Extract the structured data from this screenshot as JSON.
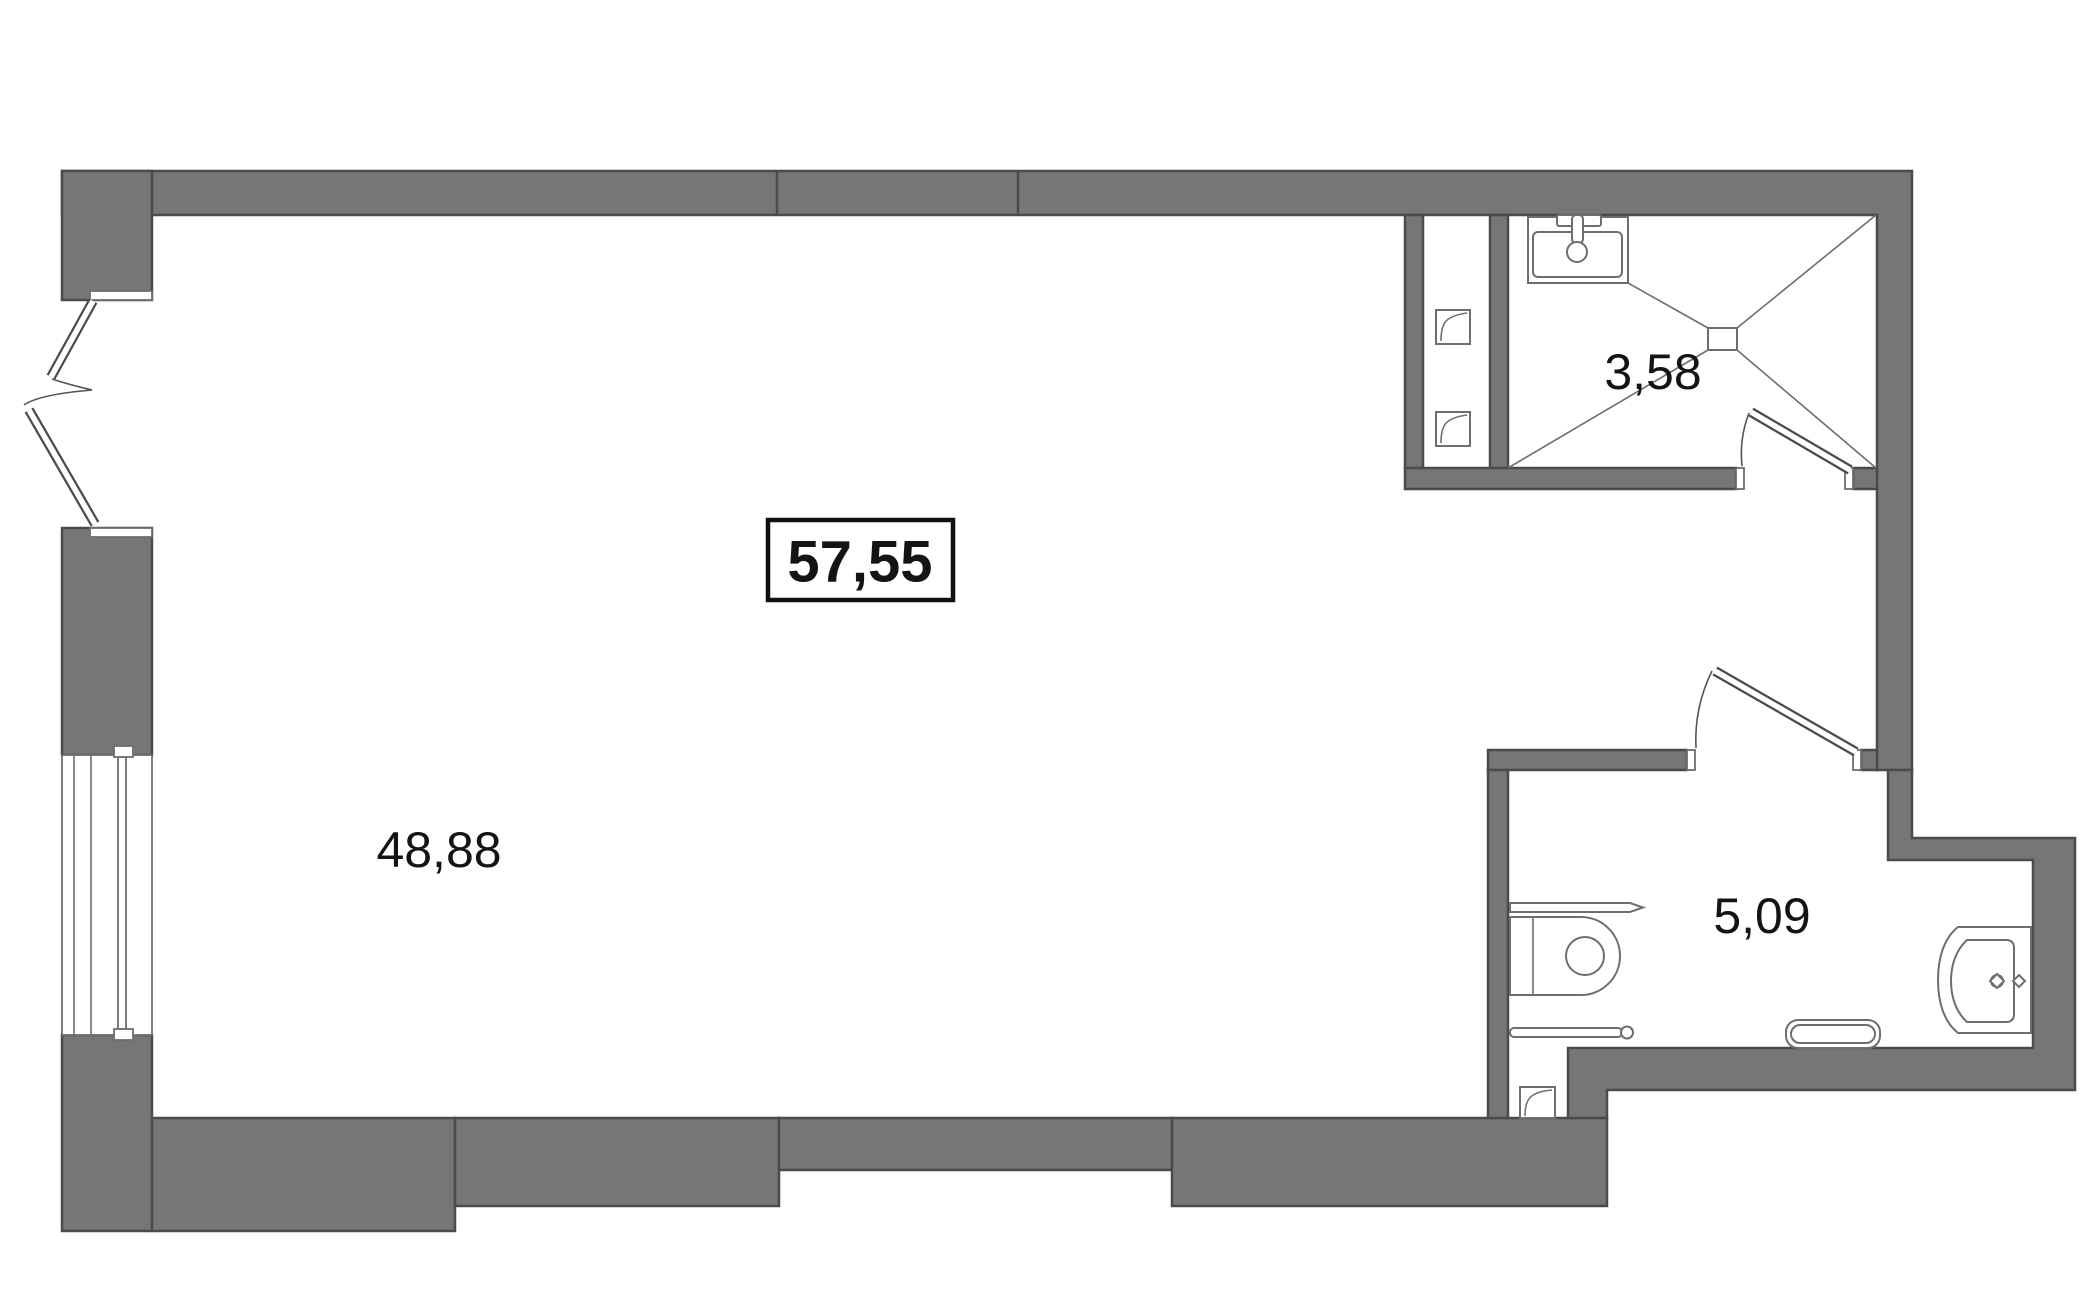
{
  "title": "apartment-floor-plan",
  "colors": {
    "wall_fill": "#767676",
    "wall_stroke": "#4b4b4b",
    "line": "#6e6e6e",
    "text": "#141414",
    "bg": "#ffffff"
  },
  "labels": {
    "total_area": "57,55",
    "living_area": "48,88",
    "shower_area": "3,58",
    "bathroom_area": "5,09"
  },
  "icons": {
    "sink": "washbasin-with-faucet",
    "shower_drain": "floor-drain-with-slope-lines",
    "toilet": "toilet-with-tank",
    "bathtub": "bathtub-with-drain-and-faucet",
    "towel_rail_top": "towel-rail",
    "towel_rail_bottom": "towel-rail-round-end",
    "radiator": "towel-radiator",
    "vent_duct": "ventilation-duct",
    "doors": "swing-door",
    "window": "double-glazed-window",
    "balcony_door": "open-balcony-door-leaves"
  }
}
